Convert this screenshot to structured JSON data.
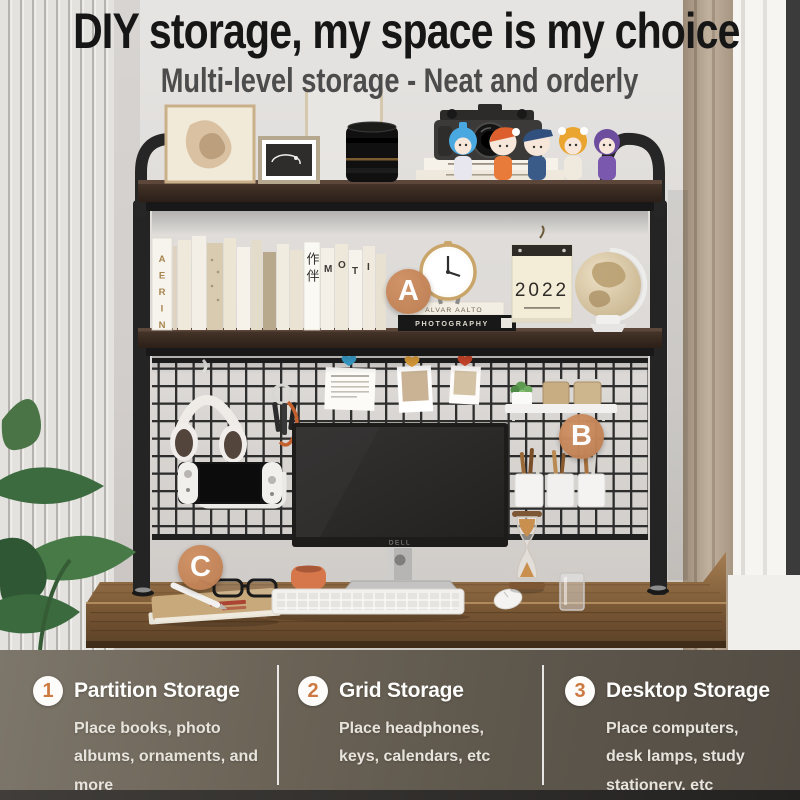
{
  "header": {
    "headline": "DIY storage, my space is my choice",
    "subheadline": "Multi-level storage - Neat and orderly"
  },
  "markers": {
    "a": "A",
    "b": "B",
    "c": "C"
  },
  "features": [
    {
      "number": "1",
      "title": "Partition Storage",
      "description": "Place books, photo albums, ornaments, and more"
    },
    {
      "number": "2",
      "title": "Grid Storage",
      "description": "Place headphones, keys, calendars, etc"
    },
    {
      "number": "3",
      "title": "Desktop Storage",
      "description": "Place computers, desk lamps, study stationery, etc"
    }
  ],
  "photo_text": {
    "book_spine_aerin": "AERIN",
    "book_spine_companion": "作伴",
    "moti_letters": [
      "M",
      "O",
      "T",
      "I"
    ],
    "book_stack_title": "ALVAR AALTO",
    "book_stack_subtitle": "PHOTOGRAPHY",
    "calendar_year": "2022",
    "monitor_brand": "DELL"
  },
  "colors": {
    "accent_orange": "#c4855a",
    "feature_number": "#cd7a42",
    "headline_text": "#161616",
    "subheadline_text": "#4c4c4c",
    "feature_bar_bg": "#665f54",
    "feature_text": "#ffffff",
    "shelf_frame": "#242424",
    "desk_wood": "#7a5836"
  }
}
